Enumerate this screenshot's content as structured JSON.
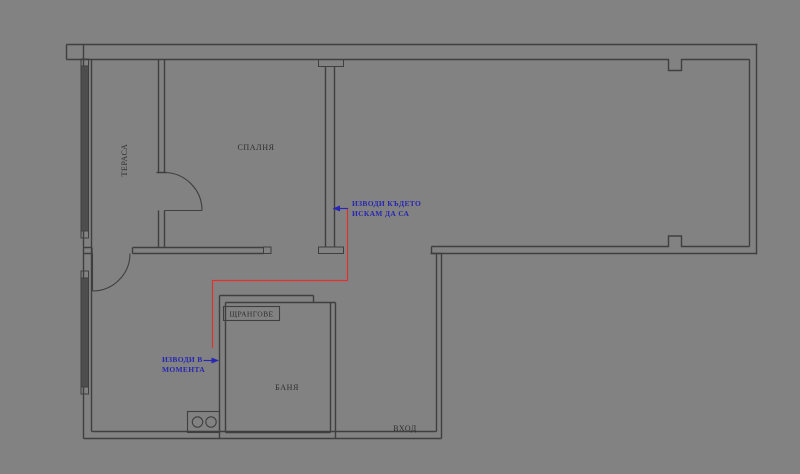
{
  "colors": {
    "bg": "#828282",
    "wall": "#3f3f3f",
    "window_fill": "#4d4d4d",
    "label": "#2d2d2d",
    "blue": "#2727b3",
    "red": "#e03030"
  },
  "floorplan": {
    "rooms": {
      "terrace_label": "ТЕРАСА",
      "bedroom_label": "СПАЛНЯ",
      "bathroom_label": "БАНЯ",
      "risers_label": "ЩРАНГОВЕ",
      "entrance_label": "ВХОД"
    },
    "annotations": {
      "desired_outlets": {
        "line1": "ИЗВОДИ КЪДЕТО",
        "line2": "ИСКАМ ДА СА"
      },
      "current_outlets": {
        "line1": "ИЗВОДИ В",
        "line2": "МОМЕНТА"
      }
    }
  }
}
